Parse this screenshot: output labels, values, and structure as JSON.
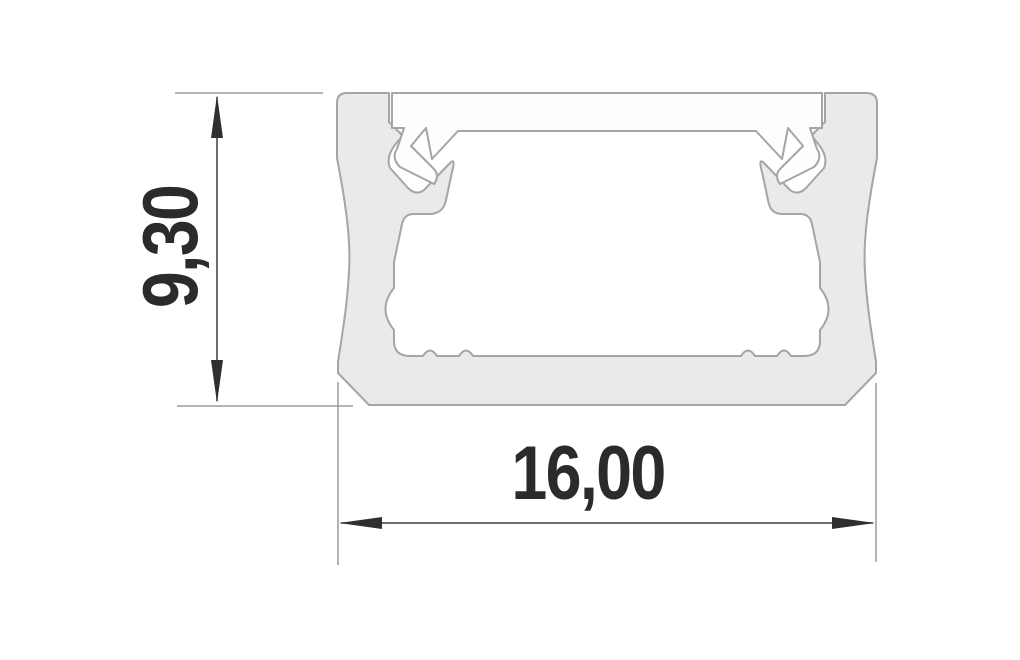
{
  "drawing": {
    "type": "technical-cross-section",
    "subject": "Aluminium LED profile cross-section with cover",
    "height_dimension": {
      "value": "9,30",
      "orientation": "vertical"
    },
    "width_dimension": {
      "value": "16,00",
      "orientation": "horizontal"
    },
    "colors": {
      "background": "#ffffff",
      "profile_fill": "#e9eae9",
      "profile_outline": "#a3a5a6",
      "cover_fill": "#fdfdfd",
      "extension_line": "#9a9c9e",
      "dimension_line": "#3d3d3d",
      "arrow": "#2f2f2f",
      "label_text": "#2b2b2b"
    }
  }
}
